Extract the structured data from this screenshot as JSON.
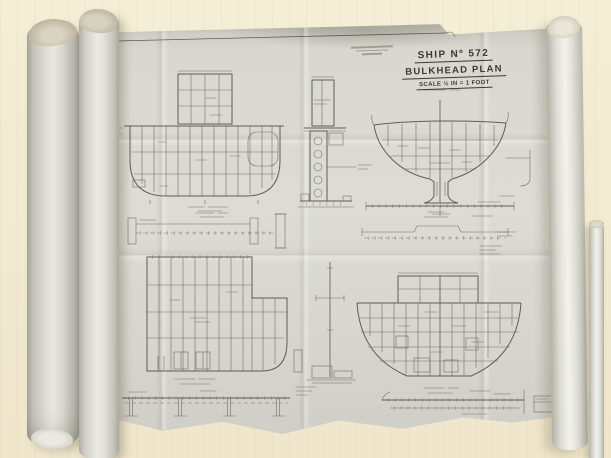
{
  "title_block": {
    "ship_no": "SHIP Nº 572",
    "plan_title": "BULKHEAD PLAN",
    "scale": "SCALE ½ IN = 1 FOOT"
  },
  "colors": {
    "table_surface": "#f1e9d0",
    "paper_sheet": "#d8d8d0",
    "paper_rolls": "#d3d4cc",
    "ink_lines": "#55534a",
    "title_ink": "#3c3a30",
    "stamp_ink": "#96887e"
  }
}
